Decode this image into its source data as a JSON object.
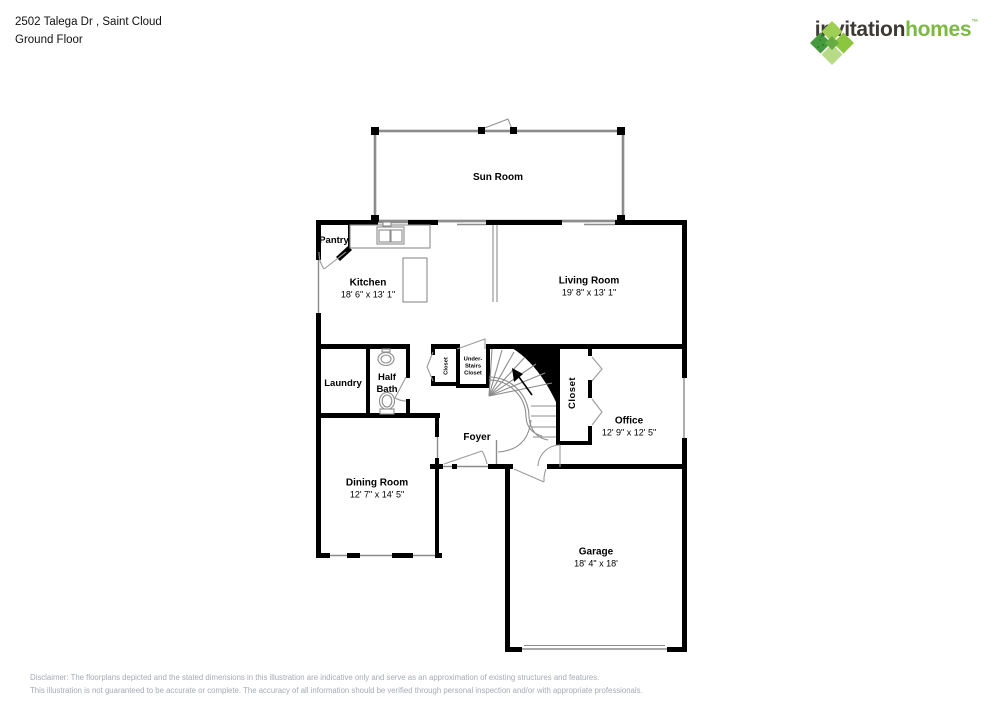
{
  "header": {
    "address_line": "2502 Talega Dr , Saint Cloud",
    "floor_line": "Ground Floor"
  },
  "logo": {
    "word1": "invitation",
    "word2": "homes",
    "trademark": "™",
    "icon": "invitation-homes-pinwheel-logo",
    "colors": {
      "word1": "#3d3935",
      "word2": "#7cb942",
      "icon_greens": [
        "#9fce54",
        "#8cc63f",
        "#b7db86",
        "#459a3d",
        "#67ab45"
      ]
    }
  },
  "rooms": [
    {
      "id": "sun-room",
      "name": "Sun Room",
      "dims": ""
    },
    {
      "id": "kitchen",
      "name": "Kitchen",
      "dims": "18' 6\" x 13' 1\""
    },
    {
      "id": "living-room",
      "name": "Living Room",
      "dims": "19' 8\" x 13' 1\""
    },
    {
      "id": "pantry",
      "name": "Pantry",
      "dims": ""
    },
    {
      "id": "laundry",
      "name": "Laundry",
      "dims": ""
    },
    {
      "id": "half-bath",
      "name": "Half Bath",
      "dims": ""
    },
    {
      "id": "foyer-closet",
      "name": "Closet",
      "dims": ""
    },
    {
      "id": "under-stairs-closet",
      "name": "Under-Stairs Closet",
      "dims": ""
    },
    {
      "id": "office-closet",
      "name": "Closet",
      "dims": ""
    },
    {
      "id": "foyer",
      "name": "Foyer",
      "dims": ""
    },
    {
      "id": "office",
      "name": "Office",
      "dims": "12' 9\" x 12' 5\""
    },
    {
      "id": "dining-room",
      "name": "Dining Room",
      "dims": "12' 7\" x 14' 5\""
    },
    {
      "id": "garage",
      "name": "Garage",
      "dims": "18' 4\" x 18'"
    }
  ],
  "fixtures": [
    "kitchen-sink",
    "kitchen-island",
    "kitchen-counter",
    "bathroom-sink",
    "toilet",
    "staircase",
    "stair-direction-arrow",
    "garage-door",
    "doors",
    "windows"
  ],
  "disclaimer": {
    "line1": "Disclaimer: The floorplans depicted and the stated dimensions in this illustration are indicative only and serve as an approximation of existing structures and features.",
    "line2": "This illustration is not guaranteed to be accurate or complete. The accuracy of all information should be verified through personal inspection and/or with appropriate professionals."
  },
  "colors": {
    "wall": "#000000",
    "thin_line": "#8c8c8c",
    "disclaimer_text": "#a7aab6",
    "background": "#ffffff"
  }
}
